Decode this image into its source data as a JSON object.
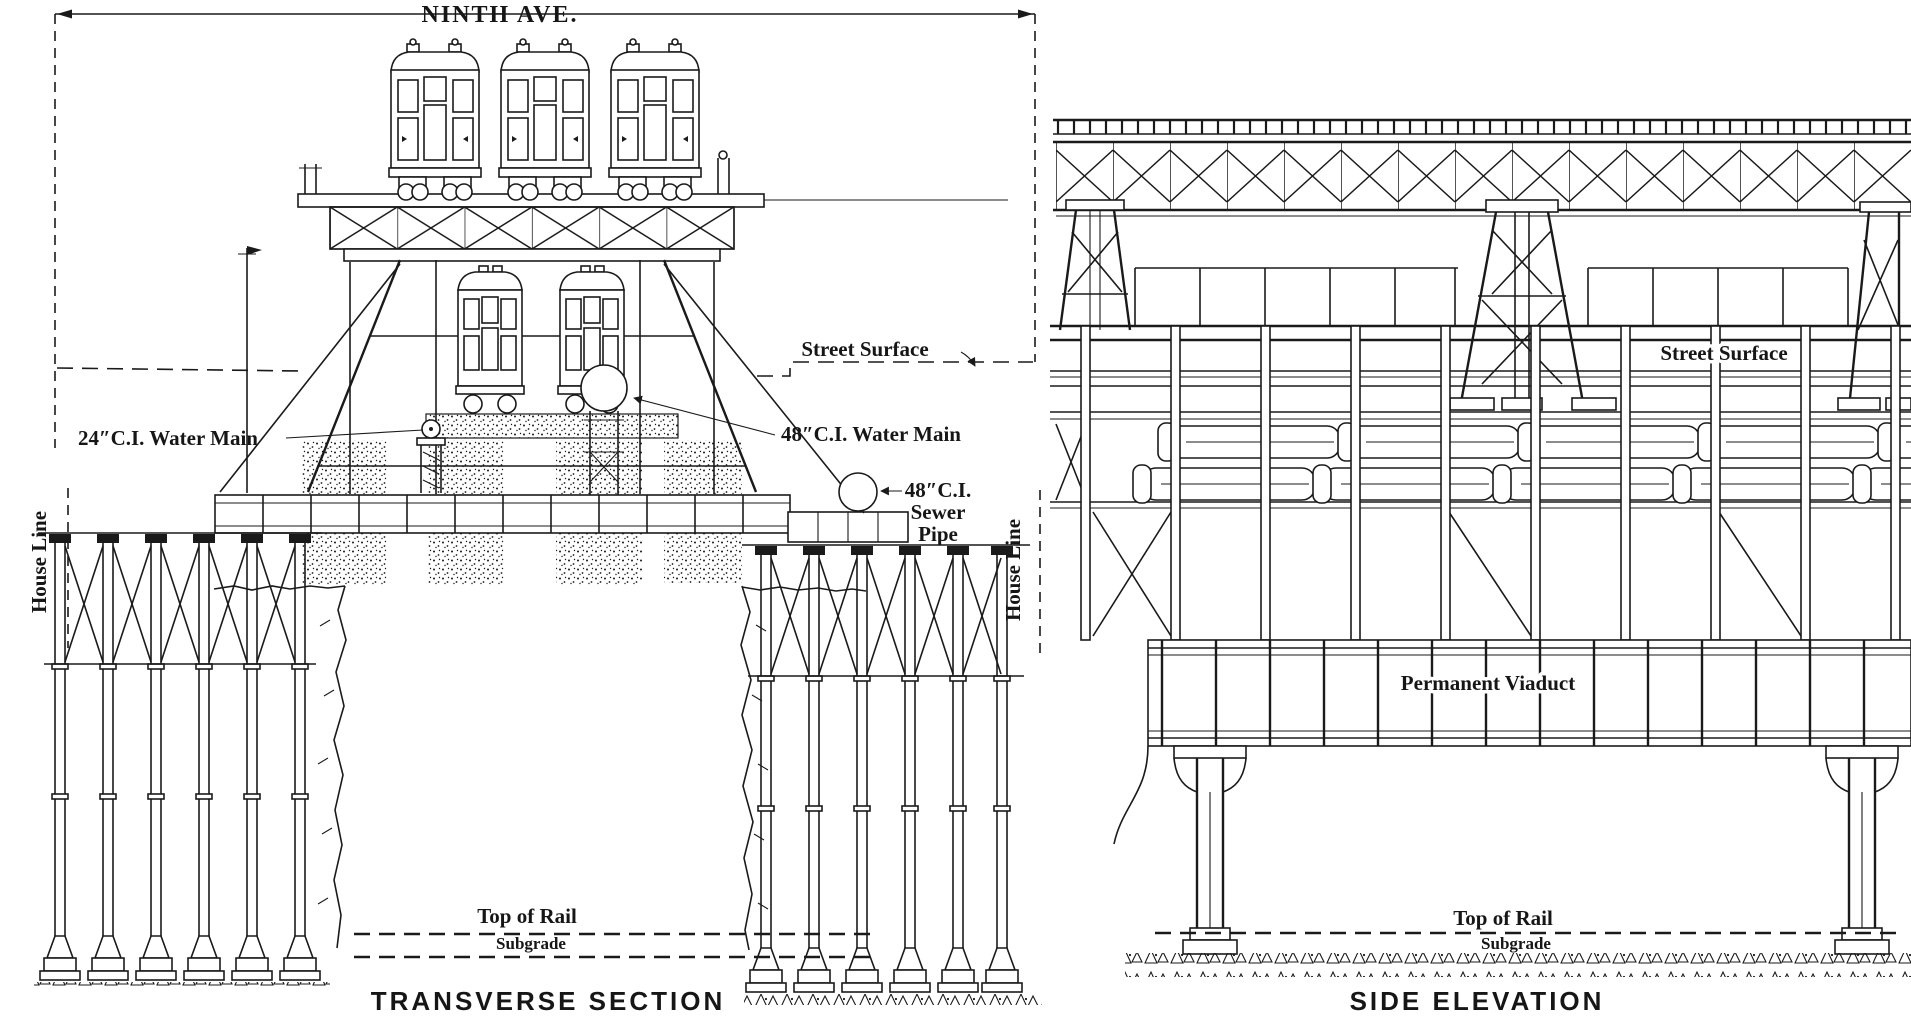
{
  "drawing": {
    "dimension_label": "NINTH AVE.",
    "transverse_section": {
      "caption": "TRANSVERSE SECTION",
      "street_surface": "Street Surface",
      "water_main_24": "24″C.I. Water Main",
      "water_main_48": "48″C.I. Water Main",
      "sewer_pipe": [
        "48″C.I.",
        "Sewer",
        "Pipe"
      ],
      "house_line_left": "House Line",
      "house_line_right": "House Line",
      "top_of_rail": "Top of Rail",
      "subgrade": "Subgrade"
    },
    "side_elevation": {
      "caption": "SIDE ELEVATION",
      "street_surface": "Street Surface",
      "permanent_viaduct": "Permanent Viaduct",
      "top_of_rail": "Top of Rail",
      "subgrade": "Subgrade"
    },
    "colors": {
      "ink": "#1a1a1a",
      "paper": "#ffffff"
    }
  }
}
